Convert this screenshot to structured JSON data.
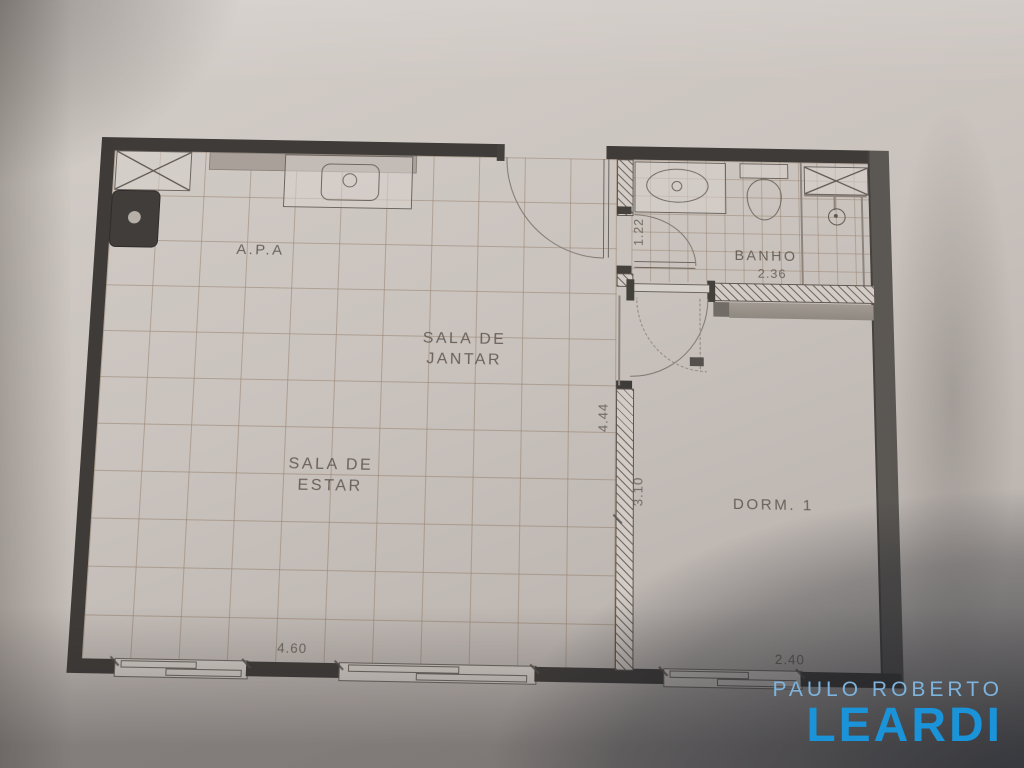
{
  "floor_plan": {
    "labels": {
      "kitchen": "A.P.A",
      "dining_line1": "SALA DE",
      "dining_line2": "JANTAR",
      "living_line1": "SALA DE",
      "living_line2": "ESTAR",
      "bathroom": "BANHO",
      "bedroom": "DORM. 1"
    },
    "dimensions": {
      "bathroom_width": "2.36",
      "bathroom_entry": "1.22",
      "living_length": "4.44",
      "bedroom_length": "3.10",
      "living_width": "4.60",
      "bedroom_width": "2.40"
    },
    "fixtures": [
      "cabinet-x",
      "kitchen-sink",
      "stove",
      "bathroom-sink",
      "toilet",
      "shower",
      "door-swing",
      "window"
    ]
  },
  "watermark": {
    "line1": "PAULO ROBERTO",
    "line2": "LEARDI"
  },
  "colors": {
    "wall_dark": "#3e3b38",
    "paper": "#c8c1bc",
    "brand_light_blue": "#7db3dc",
    "brand_blue": "#1a93d8"
  }
}
